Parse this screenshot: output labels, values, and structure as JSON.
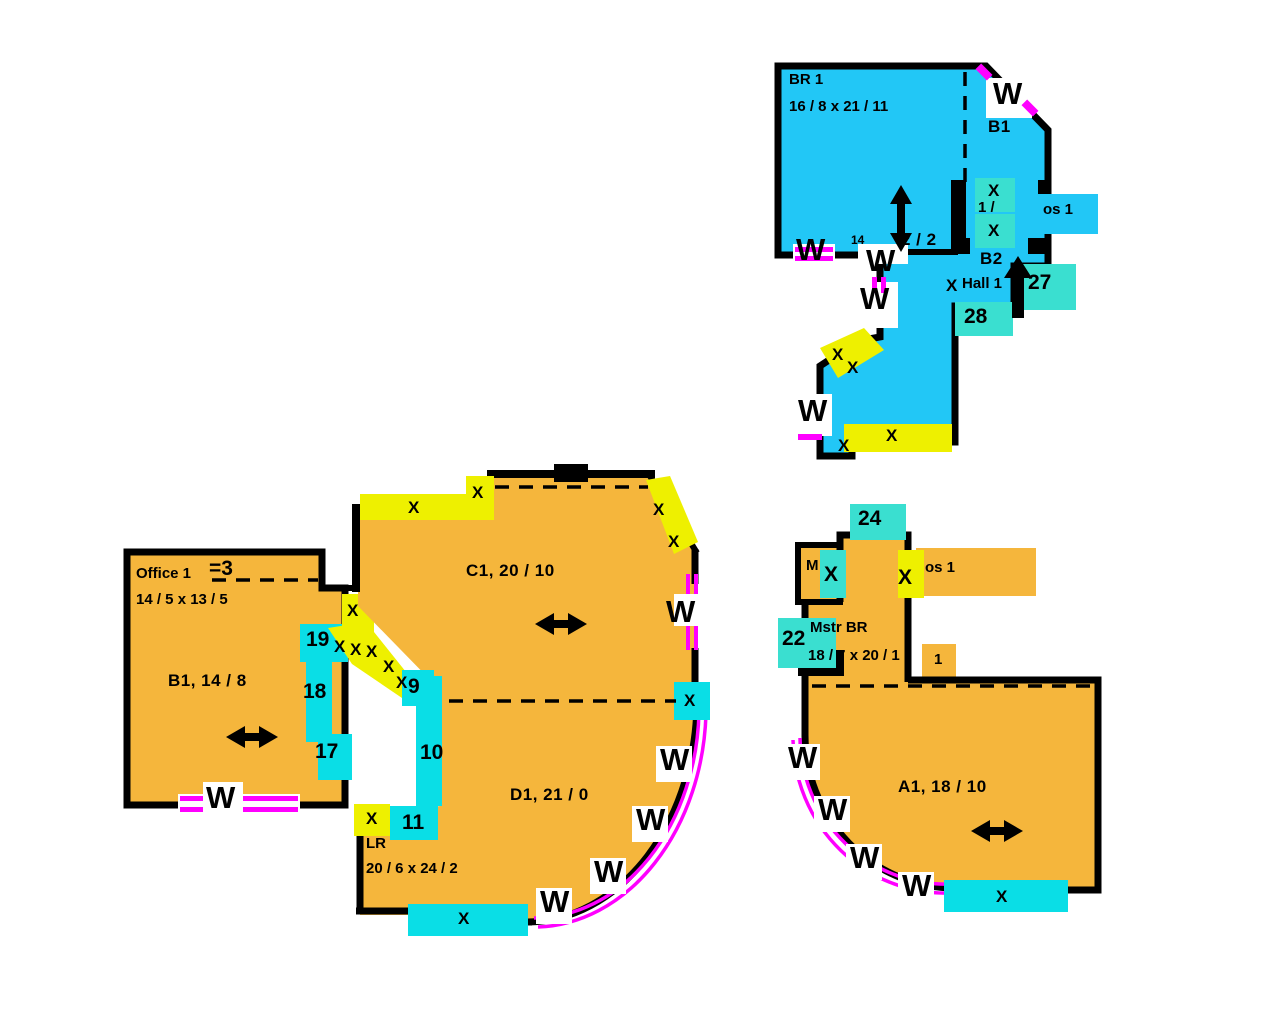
{
  "title": "Floor plan sketch",
  "colors": {
    "blue": "#22c7f6",
    "orange": "#f5b63c",
    "yellow": "#eef000",
    "cyan": "#0adee6",
    "teal": "#3adfd0",
    "magenta": "#ff00ff",
    "wall": "#000000"
  },
  "labels": [
    {
      "name": "br1-room-label",
      "text": "BR 1",
      "x": 789,
      "y": 72,
      "kind": "room15"
    },
    {
      "name": "br1-room-dims",
      "text": "16 / 8 x 21 / 11",
      "x": 789,
      "y": 99,
      "kind": "room15"
    },
    {
      "name": "b1-room-label",
      "text": "B1",
      "x": 988,
      "y": 118,
      "kind": "room17"
    },
    {
      "name": "window-label-br1-topright",
      "text": "W",
      "x": 993,
      "y": 82,
      "kind": "w"
    },
    {
      "name": "fragment-14",
      "text": "14",
      "x": 851,
      "y": 234,
      "kind": "frag12"
    },
    {
      "name": "fragment-2-2",
      "text": "2 / 2",
      "x": 901,
      "y": 231,
      "kind": "room17"
    },
    {
      "name": "window-label-br1-bottom-left",
      "text": "W",
      "x": 796,
      "y": 238,
      "kind": "w"
    },
    {
      "name": "window-label-br1-bottom-mid",
      "text": "W",
      "x": 866,
      "y": 249,
      "kind": "w"
    },
    {
      "name": "fragment-clos1-left",
      "text": "1 /",
      "x": 978,
      "y": 200,
      "kind": "room15"
    },
    {
      "name": "clos1-room-label",
      "text": "os 1",
      "x": 1043,
      "y": 202,
      "kind": "room15"
    },
    {
      "name": "x-mark-clos-top",
      "text": "X",
      "x": 988,
      "y": 182,
      "kind": "x"
    },
    {
      "name": "x-mark-clos-bottom",
      "text": "X",
      "x": 988,
      "y": 222,
      "kind": "x"
    },
    {
      "name": "b2-room-label",
      "text": "B2",
      "x": 980,
      "y": 250,
      "kind": "room17"
    },
    {
      "name": "hall1-room-label",
      "text": "Hall 1",
      "x": 962,
      "y": 276,
      "kind": "room15"
    },
    {
      "name": "x-mark-hall",
      "text": "X",
      "x": 946,
      "y": 277,
      "kind": "x"
    },
    {
      "name": "point-27",
      "text": "27",
      "x": 1028,
      "y": 272,
      "kind": "num"
    },
    {
      "name": "point-28",
      "text": "28",
      "x": 964,
      "y": 306,
      "kind": "num"
    },
    {
      "name": "window-label-corridor-top",
      "text": "W",
      "x": 860,
      "y": 287,
      "kind": "w"
    },
    {
      "name": "x-mark-corr-diag-1",
      "text": "X",
      "x": 832,
      "y": 346,
      "kind": "x"
    },
    {
      "name": "x-mark-corr-diag-2",
      "text": "X",
      "x": 847,
      "y": 359,
      "kind": "x"
    },
    {
      "name": "window-label-corridor-left",
      "text": "W",
      "x": 798,
      "y": 399,
      "kind": "w"
    },
    {
      "name": "x-mark-corr-bottom-1",
      "text": "X",
      "x": 838,
      "y": 437,
      "kind": "x"
    },
    {
      "name": "x-mark-corr-bottom-2",
      "text": "X",
      "x": 886,
      "y": 427,
      "kind": "x"
    },
    {
      "name": "office-room-label",
      "text": "Office 1",
      "x": 136,
      "y": 566,
      "kind": "room15"
    },
    {
      "name": "point-3",
      "text": "=3",
      "x": 209,
      "y": 558,
      "kind": "num"
    },
    {
      "name": "office-room-dims",
      "text": "14 / 5 x 13 / 5",
      "x": 136,
      "y": 592,
      "kind": "room15"
    },
    {
      "name": "b1-area-label",
      "text": "B1, 14 / 8",
      "x": 168,
      "y": 672,
      "kind": "room17"
    },
    {
      "name": "point-19",
      "text": "19",
      "x": 306,
      "y": 629,
      "kind": "num"
    },
    {
      "name": "x-mark-zig-0",
      "text": "X",
      "x": 347,
      "y": 602,
      "kind": "x"
    },
    {
      "name": "x-mark-zig-1",
      "text": "X",
      "x": 334,
      "y": 638,
      "kind": "x"
    },
    {
      "name": "x-mark-zig-2",
      "text": "X",
      "x": 350,
      "y": 641,
      "kind": "x"
    },
    {
      "name": "x-mark-zig-3",
      "text": "X",
      "x": 366,
      "y": 643,
      "kind": "x"
    },
    {
      "name": "x-mark-zig-4",
      "text": "X",
      "x": 383,
      "y": 658,
      "kind": "x"
    },
    {
      "name": "x-mark-zig-5",
      "text": "X",
      "x": 396,
      "y": 674,
      "kind": "x"
    },
    {
      "name": "point-18",
      "text": "18",
      "x": 303,
      "y": 681,
      "kind": "num"
    },
    {
      "name": "point-17",
      "text": "17",
      "x": 315,
      "y": 741,
      "kind": "num"
    },
    {
      "name": "window-label-b1-bottom",
      "text": "W",
      "x": 206,
      "y": 786,
      "kind": "w"
    },
    {
      "name": "x-mark-c1-top",
      "text": "X",
      "x": 408,
      "y": 499,
      "kind": "x"
    },
    {
      "name": "x-mark-c1-corner",
      "text": "X",
      "x": 472,
      "y": 484,
      "kind": "x"
    },
    {
      "name": "c1-area-label",
      "text": "C1, 20 / 10",
      "x": 466,
      "y": 562,
      "kind": "room17"
    },
    {
      "name": "x-mark-c1-diag-1",
      "text": "X",
      "x": 653,
      "y": 501,
      "kind": "x"
    },
    {
      "name": "x-mark-c1-diag-2",
      "text": "X",
      "x": 668,
      "y": 533,
      "kind": "x"
    },
    {
      "name": "window-label-c1-right",
      "text": "W",
      "x": 666,
      "y": 600,
      "kind": "w"
    },
    {
      "name": "point-9",
      "text": "9",
      "x": 408,
      "y": 676,
      "kind": "num"
    },
    {
      "name": "point-10",
      "text": "10",
      "x": 420,
      "y": 742,
      "kind": "num"
    },
    {
      "name": "x-mark-mid-right",
      "text": "X",
      "x": 684,
      "y": 692,
      "kind": "x"
    },
    {
      "name": "window-label-arc-1",
      "text": "W",
      "x": 660,
      "y": 748,
      "kind": "w"
    },
    {
      "name": "window-label-arc-2",
      "text": "W",
      "x": 636,
      "y": 808,
      "kind": "w"
    },
    {
      "name": "window-label-arc-3",
      "text": "W",
      "x": 594,
      "y": 860,
      "kind": "w"
    },
    {
      "name": "window-label-arc-4",
      "text": "W",
      "x": 540,
      "y": 890,
      "kind": "w"
    },
    {
      "name": "x-mark-lr-left",
      "text": "X",
      "x": 366,
      "y": 810,
      "kind": "x"
    },
    {
      "name": "point-11",
      "text": "11",
      "x": 402,
      "y": 812,
      "kind": "num"
    },
    {
      "name": "lr-room-label",
      "text": "LR",
      "x": 366,
      "y": 836,
      "kind": "room15"
    },
    {
      "name": "lr-room-dims",
      "text": "20 / 6 x 24 / 2",
      "x": 366,
      "y": 861,
      "kind": "room15"
    },
    {
      "name": "d1-area-label",
      "text": "D1, 21 / 0",
      "x": 510,
      "y": 786,
      "kind": "room17"
    },
    {
      "name": "x-mark-lr-bottom",
      "text": "X",
      "x": 458,
      "y": 910,
      "kind": "x"
    },
    {
      "name": "point-24",
      "text": "24",
      "x": 858,
      "y": 508,
      "kind": "num"
    },
    {
      "name": "m-room-label",
      "text": "M",
      "x": 806,
      "y": 558,
      "kind": "room15"
    },
    {
      "name": "x-mark-m-closet",
      "text": "X",
      "x": 824,
      "y": 564,
      "kind": "xbig"
    },
    {
      "name": "x-mark-clos2",
      "text": "X",
      "x": 898,
      "y": 567,
      "kind": "xbig"
    },
    {
      "name": "clos2-room-label",
      "text": "os 1",
      "x": 925,
      "y": 560,
      "kind": "room15"
    },
    {
      "name": "point-22",
      "text": "22",
      "x": 782,
      "y": 628,
      "kind": "num"
    },
    {
      "name": "mstr-br-room-label",
      "text": "Mstr BR",
      "x": 810,
      "y": 620,
      "kind": "room15"
    },
    {
      "name": "mstr-br-room-dims",
      "text": "18 / 7 x 20 / 1",
      "x": 808,
      "y": 648,
      "kind": "room15"
    },
    {
      "name": "point-1-fragment",
      "text": "1",
      "x": 934,
      "y": 652,
      "kind": "room15"
    },
    {
      "name": "a1-area-label",
      "text": "A1, 18 / 10",
      "x": 898,
      "y": 778,
      "kind": "room17"
    },
    {
      "name": "window-label-a1-arc-1",
      "text": "W",
      "x": 788,
      "y": 746,
      "kind": "w"
    },
    {
      "name": "window-label-a1-arc-2",
      "text": "W",
      "x": 818,
      "y": 798,
      "kind": "w"
    },
    {
      "name": "window-label-a1-arc-3",
      "text": "W",
      "x": 850,
      "y": 846,
      "kind": "w"
    },
    {
      "name": "window-label-a1-arc-4",
      "text": "W",
      "x": 902,
      "y": 874,
      "kind": "w"
    },
    {
      "name": "x-mark-a1-bottom",
      "text": "X",
      "x": 996,
      "y": 888,
      "kind": "x"
    }
  ]
}
